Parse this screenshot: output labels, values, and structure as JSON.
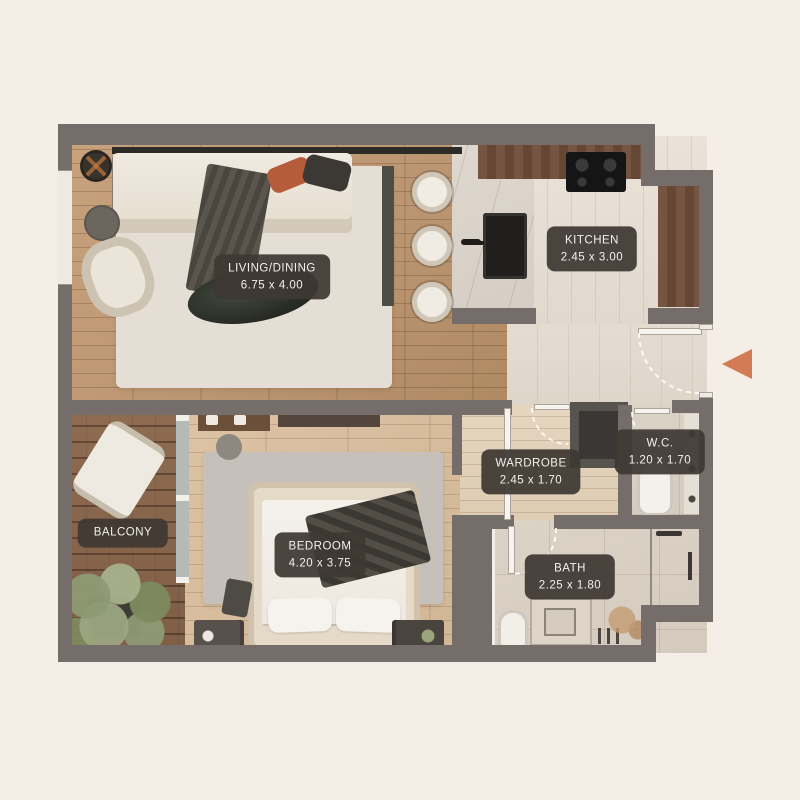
{
  "page": {
    "background": "#F5EEE6"
  },
  "plan": {
    "type": "apartment-floorplan-top-view",
    "wall_color": "#756D69",
    "label_bg": "#3E3833",
    "label_text_color": "#F3F0ED",
    "entry_arrow_color": "#D27B55",
    "entry_arrow_icon": "entrance-arrow-left"
  },
  "rooms": {
    "living": {
      "label": "LIVING/DINING",
      "dims": "6.75 x 4.00"
    },
    "kitchen": {
      "label": "KITCHEN",
      "dims": "2.45 x 3.00"
    },
    "wardrobe": {
      "label": "WARDROBE",
      "dims": "2.45 x 1.70"
    },
    "wc": {
      "label": "W.C.",
      "dims": "1.20 x 1.70"
    },
    "bath": {
      "label": "BATH",
      "dims": "2.25 x 1.80"
    },
    "bedroom": {
      "label": "BEDROOM",
      "dims": "4.20 x 3.75"
    },
    "balcony": {
      "label": "BALCONY",
      "dims": ""
    }
  }
}
